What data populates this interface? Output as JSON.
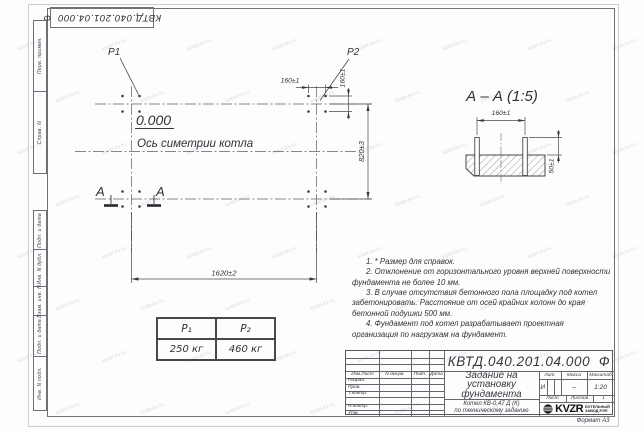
{
  "sheet": {
    "doc_full": "КВТД.040.201.04.000  Ф",
    "format_label": "Формат А3",
    "watermark": "kotel-kv.ru"
  },
  "margin": {
    "labels": [
      "Перв. примен.",
      "Справ. N",
      "Подп. и дата",
      "Инв. N дубл.",
      "Взам. инв. N",
      "Подп. и дата",
      "Инв. N подл."
    ]
  },
  "plan": {
    "p1": "P1",
    "p2": "P2",
    "elevation": "0.000",
    "axis_label": "Ось симетрии котла",
    "section_letter": "А",
    "dim_160_h": "160±1",
    "dim_160_v": "160±1",
    "dim_820": "820±3",
    "dim_1620": "1620±2"
  },
  "section_view": {
    "title": "А – А (1:5)",
    "dim_160": "160±1",
    "dim_50": "50±1"
  },
  "load_table": {
    "col1_header": "P₁",
    "col2_header": "P₂",
    "col1_value": "250 кг",
    "col2_value": "460 кг"
  },
  "notes": [
    "1. * Размер для справок.",
    "2. Отклонение от горизонтального уровня верхней поверхности фундамента не более 10 мм.",
    "3. В случае отсутствия бетонного пола площадку под котел забетонировать. Расстояние от осей крайних колонн до края бетонной подушки 500 мм.",
    "4. Фундамент под котел разрабатывает проектная организация по нагрузкам на фундамент."
  ],
  "title_block": {
    "doc_full": "КВТД.040.201.04.000  Ф",
    "title_lines": [
      "Задание на",
      "установку",
      "фундамента"
    ],
    "product_line1": "Котел  КВ-0,47 Д (К)",
    "product_line2": "по техническому заданию",
    "cols": [
      "Изм.Лист",
      "N докум.",
      "Подп.",
      "Дата"
    ],
    "rows": [
      "Разраб.",
      "Пров.",
      "Т.контр.",
      "Н.контр.",
      "Утв."
    ],
    "lit_label": "Лит.",
    "mass_label": "Масса",
    "scale_label": "Масштаб",
    "lit_value": "И",
    "mass_value": "–",
    "scale_value": "1:20",
    "sheet_label": "Лист",
    "sheets_label": "Листов",
    "sheets_value": "1",
    "logo_text": "KVZR",
    "logo_line1": "КОТЕЛЬНЫЙ",
    "logo_line2": "ЗАВОД РЭП"
  }
}
